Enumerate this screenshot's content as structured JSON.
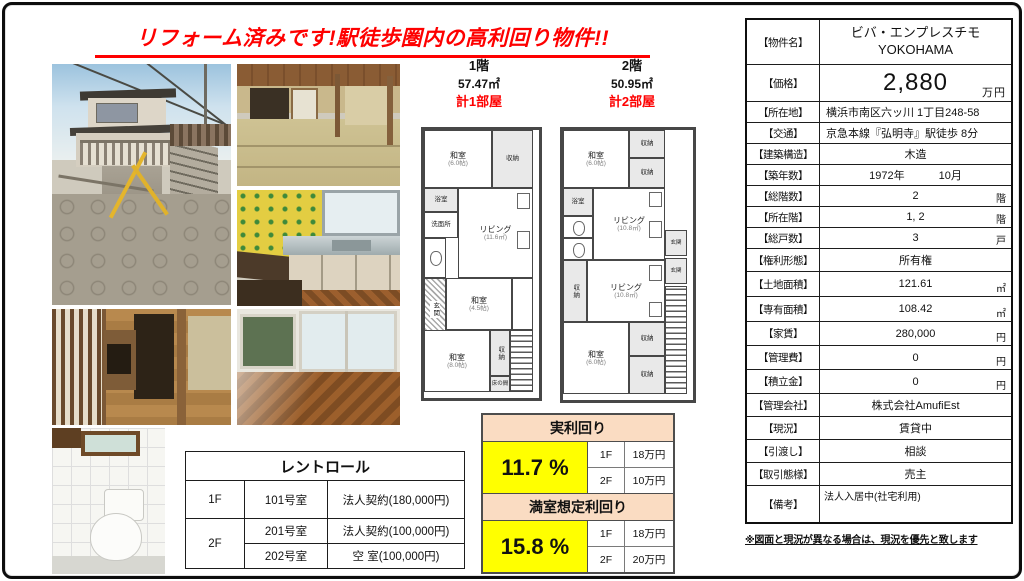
{
  "page": {
    "title": "リフォーム済みです!駅徒歩圏内の高利回り物件!!",
    "footnote": "※図面と現況が異なる場合は、現況を優先と致します",
    "watermark": "myhome-cloud"
  },
  "colors": {
    "headline_red": "#fe0000",
    "yield_value_yellow": "#ffff00",
    "yield_header_peach": "#fadcc2"
  },
  "floorplan_1f": {
    "floor": "1階",
    "area": "57.47㎡",
    "room_count": "計1部屋",
    "washitsu_top": "和室",
    "washitsu_top_size": "(6.0帖)",
    "closet_top": "収納",
    "bath": "浴室",
    "washroom": "洗面所",
    "toilet": "トイレ",
    "living": "リビング",
    "living_size": "(11.6㎡)",
    "washitsu_mid": "和室",
    "washitsu_mid_size": "(4.5帖)",
    "entrance": "玄関",
    "washitsu_btm": "和室",
    "washitsu_btm_size": "(8.0帖)",
    "closet_btm": "収納",
    "tokonoma": "床の間"
  },
  "floorplan_2f": {
    "floor": "2階",
    "area": "50.95㎡",
    "room_count": "計2部屋",
    "washitsu_top": "和室",
    "washitsu_top_size": "(6.0帖)",
    "closet1": "収納",
    "closet2": "収納",
    "bath": "浴室",
    "living1": "リビング",
    "living1_size": "(10.8㎡)",
    "entrance1": "玄関",
    "entrance2": "玄関",
    "closet_mid": "収納",
    "living2": "リビング",
    "living2_size": "(10.8㎡)",
    "washitsu_btm": "和室",
    "washitsu_btm_size": "(6.0帖)",
    "closet3": "収納",
    "closet4": "収納"
  },
  "rentroll": {
    "title": "レントロール",
    "rows": [
      {
        "floor": "1F",
        "room": "101号室",
        "status": "法人契約(180,000円)"
      },
      {
        "floor": "2F",
        "room": "201号室",
        "status": "法人契約(100,000円)"
      },
      {
        "room": "202号室",
        "status": "空 室(100,000円)"
      }
    ]
  },
  "yield": {
    "actual_title": "実利回り",
    "actual_value": "11.7 %",
    "actual_rows": [
      {
        "floor": "1F",
        "rent": "18万円"
      },
      {
        "floor": "2F",
        "rent": "10万円"
      }
    ],
    "full_title": "満室想定利回り",
    "full_value": "15.8 %",
    "full_rows": [
      {
        "floor": "1F",
        "rent": "18万円"
      },
      {
        "floor": "2F",
        "rent": "20万円"
      }
    ]
  },
  "property": {
    "name_label": "【物件名】",
    "name_line1": "ビバ・エンプレスチモ",
    "name_line2": "YOKOHAMA",
    "price_label": "【価格】",
    "price": "2,880",
    "price_unit": "万円",
    "address_label": "【所在地】",
    "address": "横浜市南区六ッ川 1丁目248-58",
    "access_label": "【交通】",
    "access": "京急本線『弘明寺』駅徒歩 8分",
    "structure_label": "【建築構造】",
    "structure": "木造",
    "built_label": "【築年数】",
    "built_year": "1972年",
    "built_month": "10月",
    "floors_label": "【総階数】",
    "floors": "2",
    "floors_unit": "階",
    "located_label": "【所在階】",
    "located": "1, 2",
    "located_unit": "階",
    "units_label": "【総戸数】",
    "units": "3",
    "units_unit": "戸",
    "rights_label": "【権利形態】",
    "rights": "所有権",
    "land_label": "【土地面積】",
    "land": "121.61",
    "land_unit": "㎡",
    "building_label": "【専有面積】",
    "building": "108.42",
    "building_unit": "㎡",
    "rent_label": "【家賃】",
    "rent": "280,000",
    "rent_unit": "円",
    "mgmtfee_label": "【管理費】",
    "mgmtfee": "0",
    "mgmtfee_unit": "円",
    "reserve_label": "【積立金】",
    "reserve": "0",
    "reserve_unit": "円",
    "mgmtco_label": "【管理会社】",
    "mgmtco": "株式会社AmufiEst",
    "status_label": "【現況】",
    "status": "賃貸中",
    "handover_label": "【引渡し】",
    "handover": "相談",
    "deal_label": "【取引態様】",
    "deal": "売主",
    "notes_label": "【備考】",
    "notes": "法人入居中(社宅利用)"
  }
}
